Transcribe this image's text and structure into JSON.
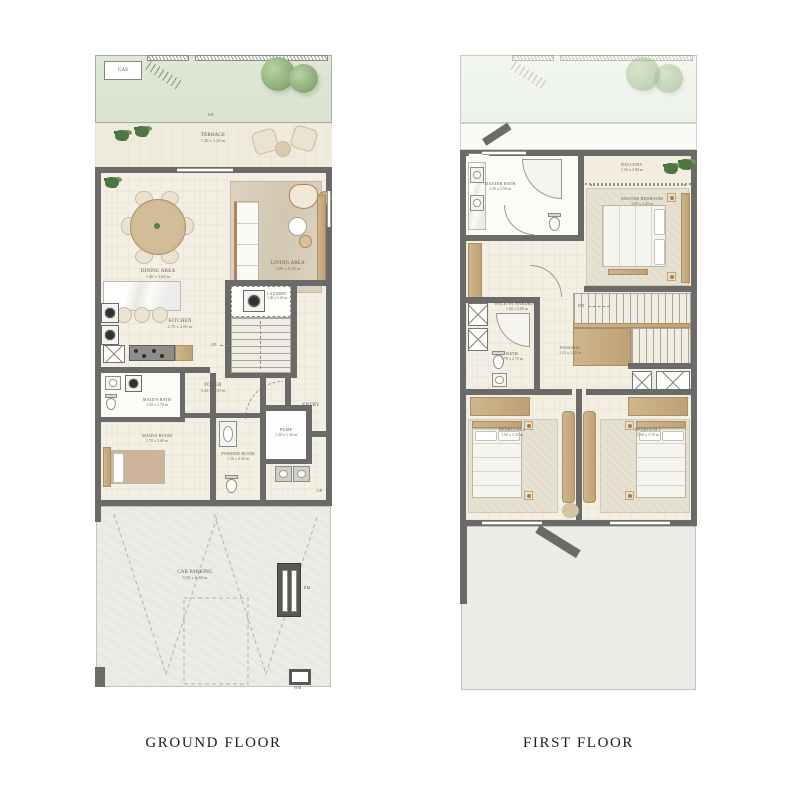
{
  "meta": {
    "background": "#ffffff"
  },
  "colors": {
    "wall": "#6a6a68",
    "floor_cream": "#f3efe3",
    "garden_green": "#dde7d5",
    "parking_gray": "#e8e8e5",
    "wood_accent": "#c9a76a",
    "tree_green": "#85a871"
  },
  "ground_floor": {
    "title": "GROUND FLOOR",
    "rooms": {
      "terrace": {
        "name": "TERRACE",
        "dims": "7.30 x 1.20 m"
      },
      "dining": {
        "name": "DINING AREA",
        "dims": "3.40 x 3.60 m"
      },
      "living": {
        "name": "LIVING AREA",
        "dims": "3.80 x 5.10 m"
      },
      "kitchen": {
        "name": "KITCHEN",
        "dims": "2.70 x 2.60 m"
      },
      "laundry": {
        "name": "LAUNDRY",
        "dims": "1.00 x 1.30 m"
      },
      "foyer": {
        "name": "FOYER",
        "dims": "3.40 x 1.30 m"
      },
      "entry": {
        "name": "ENTRY",
        "dims": ""
      },
      "maids_bath": {
        "name": "MAID'S BATH",
        "dims": "1.50 x 1.70 m"
      },
      "maids_room": {
        "name": "MAID'S ROOM",
        "dims": "2.70 x 2.60 m"
      },
      "powder": {
        "name": "POWDER ROOM",
        "dims": "1.50 x 2.30 m"
      },
      "pump": {
        "name": "PUMP",
        "dims": "1.30 x 1.30 m"
      },
      "parking": {
        "name": "CAR PARKING",
        "dims": "5.50 x 6.30 m"
      }
    },
    "markers": {
      "gas": "GAS",
      "up_garden": "UP",
      "up_stairs": "UP",
      "up_entry": "UP",
      "em": "EM",
      "wm": "WM"
    }
  },
  "first_floor": {
    "title": "FIRST FLOOR",
    "rooms": {
      "balcony": {
        "name": "BALCONY",
        "dims": "1.50 x 4.90 m"
      },
      "master_bath": {
        "name": "MASTER BATH",
        "dims": "3.20 x 2.50 m"
      },
      "master_bedroom": {
        "name": "MASTER BEDROOM",
        "dims": "3.90 x 3.20 m"
      },
      "wardrobe": {
        "name": "WALK-IN WARDROBE",
        "dims": "1.60 x 2.00 m"
      },
      "bath": {
        "name": "BATH",
        "dims": "1.70 x 2.70 m"
      },
      "passage": {
        "name": "PASSAGE",
        "dims": "3.25 x 2.20 m"
      },
      "bedroom1": {
        "name": "BEDROOM 1",
        "dims": "3.50 x 3.25 m"
      },
      "bedroom2": {
        "name": "BEDROOM 2",
        "dims": "3.00 x 3.70 m"
      }
    },
    "markers": {
      "dn": "DN"
    }
  }
}
